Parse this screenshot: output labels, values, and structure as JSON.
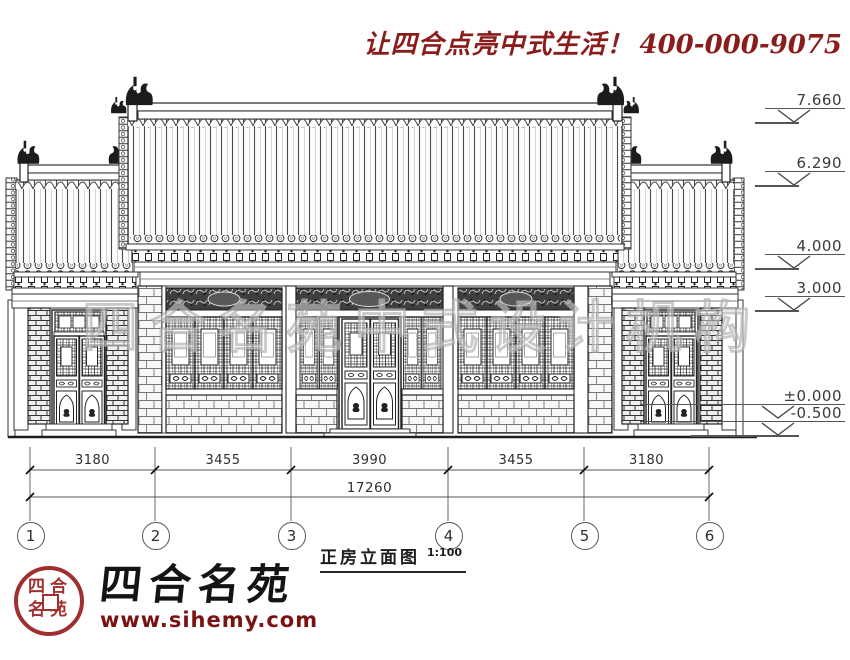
{
  "header": {
    "slogan": "让四合点亮中式生活！",
    "phone": "400-000-9075"
  },
  "drawing": {
    "title": "正房立面图",
    "scale": "1:100",
    "levels": [
      "7.660",
      "6.290",
      "4.000",
      "3.000",
      "±0.000",
      "-0.500"
    ],
    "dimensions": {
      "segments": [
        "3180",
        "3455",
        "3990",
        "3455",
        "3180"
      ],
      "total": "17260"
    },
    "grid_bubbles": [
      "1",
      "2",
      "3",
      "4",
      "5",
      "6"
    ]
  },
  "watermark": "四合名苑中式设计机构",
  "logo": {
    "brand": "四合名苑",
    "website": "www.sihemy.com",
    "seal_text": "四合名苑"
  },
  "colors": {
    "accent_red": "#8a1c1c",
    "line_dark": "#2f2f2f"
  }
}
